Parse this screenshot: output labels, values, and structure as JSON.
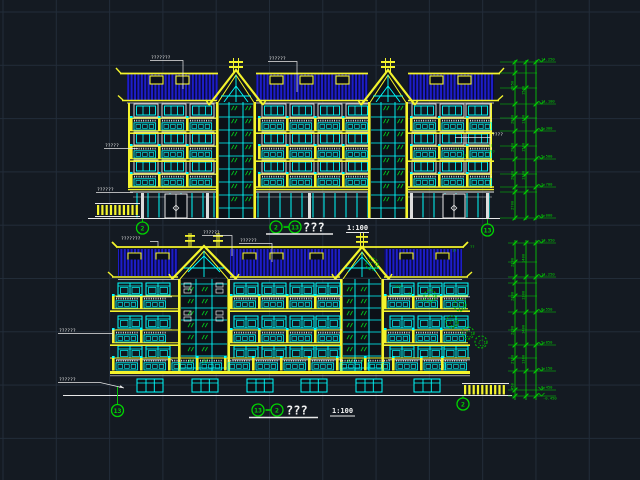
{
  "canvas": {
    "kind": "cad-elevation-drawing",
    "background": "#141a22",
    "grid_color": "#222c39"
  },
  "palette": {
    "yellow": "#f4f42c",
    "cyan": "#00ffff",
    "roof_blue": "#1d1dc9",
    "green": "#00d400",
    "white": "#e8e8e8"
  },
  "top": {
    "title": {
      "axis_from": "2",
      "axis_to": "13",
      "name": "???",
      "scale": "1:100"
    },
    "axis": {
      "left": "2",
      "right": "13",
      "left_caption": "???????"
    },
    "labels": {
      "roof_left": "???????",
      "roof_right": "??????",
      "wall_upper": "?????",
      "wall_lower": "??????",
      "right_side": "????"
    },
    "notes": [
      "??",
      "???",
      "??",
      "??"
    ],
    "levels": [
      "14.250",
      "11.100",
      "8.300",
      "5.500",
      "2.700",
      "0.000"
    ],
    "dims": [
      "2850",
      "2800",
      "2800",
      "2800",
      "2700"
    ],
    "dims2": [
      "1500",
      "1300",
      "1500",
      "1300"
    ]
  },
  "bottom": {
    "title": {
      "axis_from": "13",
      "axis_to": "2",
      "name": "???",
      "scale": "1:100"
    },
    "axis": {
      "left": "13",
      "right": "2"
    },
    "labels": {
      "roof_left": "??????",
      "roof_right": "??????",
      "wall_upper": "??????",
      "wall_lower": "??????"
    },
    "notes": [
      "??",
      "??",
      "???",
      "??",
      "??"
    ],
    "levels": [
      "13.950",
      "11.250",
      "8.550",
      "5.850",
      "3.150",
      "0.450",
      "-0.450"
    ],
    "dims": [
      "2700",
      "2700",
      "2700",
      "2700",
      "450"
    ],
    "dims2": [
      "1400",
      "1300",
      "1400",
      "1300"
    ]
  }
}
